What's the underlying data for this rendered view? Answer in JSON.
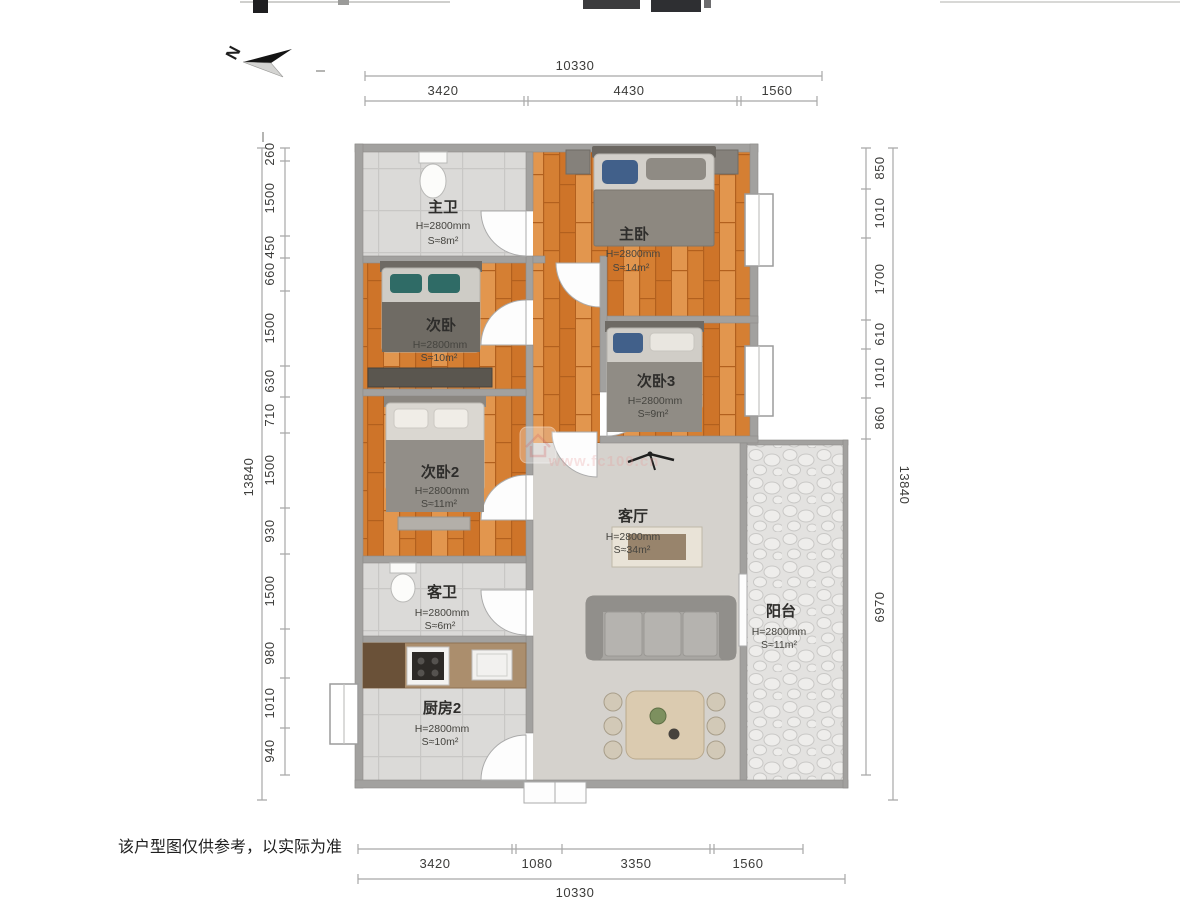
{
  "north": {
    "label": "N"
  },
  "disclaimer": "该户型图仅供参考，以实际为准",
  "watermark": {
    "url": "www.fc100.cn"
  },
  "rooms": [
    {
      "id": "master-bath",
      "name": "主卫",
      "height": "H=2800mm",
      "area": "S≈8m²"
    },
    {
      "id": "master-bedroom",
      "name": "主卧",
      "height": "H=2800mm",
      "area": "S≈14m²"
    },
    {
      "id": "bedroom-second",
      "name": "次卧",
      "height": "H=2800mm",
      "area": "S≈10m²"
    },
    {
      "id": "bedroom-3",
      "name": "次卧3",
      "height": "H=2800mm",
      "area": "S≈9m²"
    },
    {
      "id": "bedroom-2",
      "name": "次卧2",
      "height": "H=2800mm",
      "area": "S≈11m²"
    },
    {
      "id": "living-room",
      "name": "客厅",
      "height": "H=2800mm",
      "area": "S≈34m²"
    },
    {
      "id": "guest-bath",
      "name": "客卫",
      "height": "H=2800mm",
      "area": "S≈6m²"
    },
    {
      "id": "kitchen",
      "name": "厨房2",
      "height": "H=2800mm",
      "area": "S≈10m²"
    },
    {
      "id": "balcony",
      "name": "阳台",
      "height": "H=2800mm",
      "area": "S≈11m²"
    }
  ],
  "dimensions": {
    "top": {
      "total": "10330",
      "segments": [
        "3420",
        "4430",
        "1560"
      ]
    },
    "bottom": {
      "total": "10330",
      "segments": [
        "3420",
        "1080",
        "3350",
        "1560"
      ]
    },
    "left": {
      "total": "13840",
      "segments": [
        "260",
        "1500",
        "450",
        "660",
        "1500",
        "630",
        "710",
        "1500",
        "930",
        "1500",
        "980",
        "1010",
        "940"
      ]
    },
    "right": {
      "total": "13840",
      "segments": [
        "850",
        "1010",
        "1700",
        "610",
        "1010",
        "860",
        "6970"
      ]
    }
  },
  "colors": {
    "wall": "#a2a19f",
    "wood": "#db8a3e",
    "tile": "#dbdad8",
    "living_floor": "#d5d2cd",
    "pillow_teal": "#2f6b66",
    "pillow_navy": "#41608a"
  }
}
